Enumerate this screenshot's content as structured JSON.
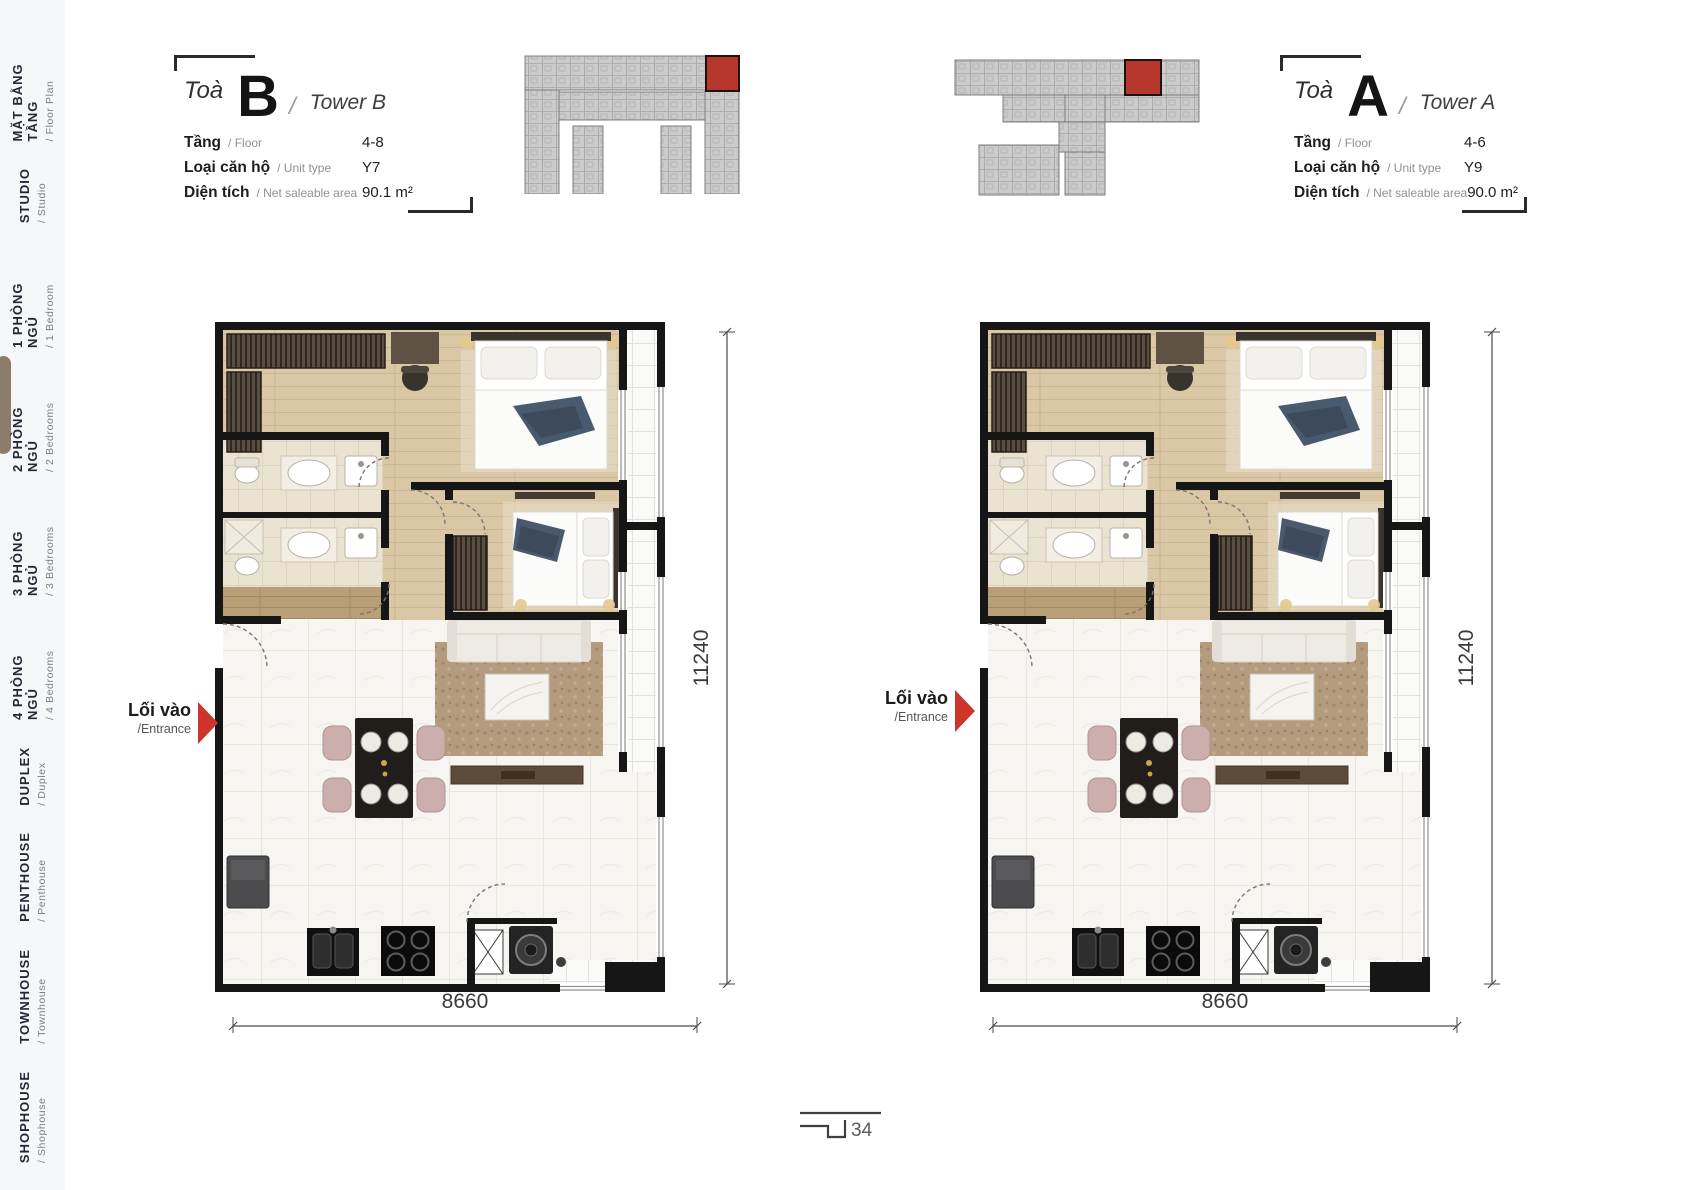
{
  "sidebar": {
    "active_index": 3,
    "items": [
      {
        "title": "MẶT BẰNG TẦNG",
        "subtitle": "/ Floor Plan"
      },
      {
        "title": "STUDIO",
        "subtitle": "/ Studio"
      },
      {
        "title": "1 PHÒNG NGỦ",
        "subtitle": "/ 1 Bedroom"
      },
      {
        "title": "2 PHÒNG NGỦ",
        "subtitle": "/ 2 Bedrooms"
      },
      {
        "title": "3 PHÒNG NGỦ",
        "subtitle": "/ 3 Bedrooms"
      },
      {
        "title": "4 PHÒNG NGỦ",
        "subtitle": "/ 4 Bedrooms"
      },
      {
        "title": "DUPLEX",
        "subtitle": "/ Duplex"
      },
      {
        "title": "PENTHOUSE",
        "subtitle": "/ Penthouse"
      },
      {
        "title": "TOWNHOUSE",
        "subtitle": "/ Townhouse"
      },
      {
        "title": "SHOPHOUSE",
        "subtitle": "/ Shophouse"
      }
    ]
  },
  "towers": {
    "b": {
      "prefix": "Toà",
      "letter": "B",
      "slash": "/",
      "name": "Tower B",
      "rows": [
        {
          "label_vi": "Tầng",
          "label_en": "/ Floor",
          "value": "4-8"
        },
        {
          "label_vi": "Loại căn hộ",
          "label_en": "/ Unit type",
          "value": "Y7"
        },
        {
          "label_vi": "Diện tích",
          "label_en": "/ Net saleable area",
          "value": "90.1 m²"
        }
      ]
    },
    "a": {
      "prefix": "Toà",
      "letter": "A",
      "slash": "/",
      "name": "Tower A",
      "rows": [
        {
          "label_vi": "Tầng",
          "label_en": "/ Floor",
          "value": "4-6"
        },
        {
          "label_vi": "Loại căn hộ",
          "label_en": "/ Unit type",
          "value": "Y9"
        },
        {
          "label_vi": "Diện tích",
          "label_en": "/ Net saleable area",
          "value": "90.0 m²"
        }
      ]
    }
  },
  "plan": {
    "entrance_vi": "Lối vào",
    "entrance_en": "/Entrance",
    "dim_width": "8660",
    "dim_height": "11240"
  },
  "page": {
    "number": "34"
  },
  "colors": {
    "accent_red": "#c5372c",
    "active_tab": "#8c7d6b",
    "wall": "#161616",
    "wood_floor": "#d9c6a5",
    "bath_tile": "#ebe3d1",
    "marble": "#f7f5f1",
    "keyplan_gray": "#cbcbcb"
  }
}
